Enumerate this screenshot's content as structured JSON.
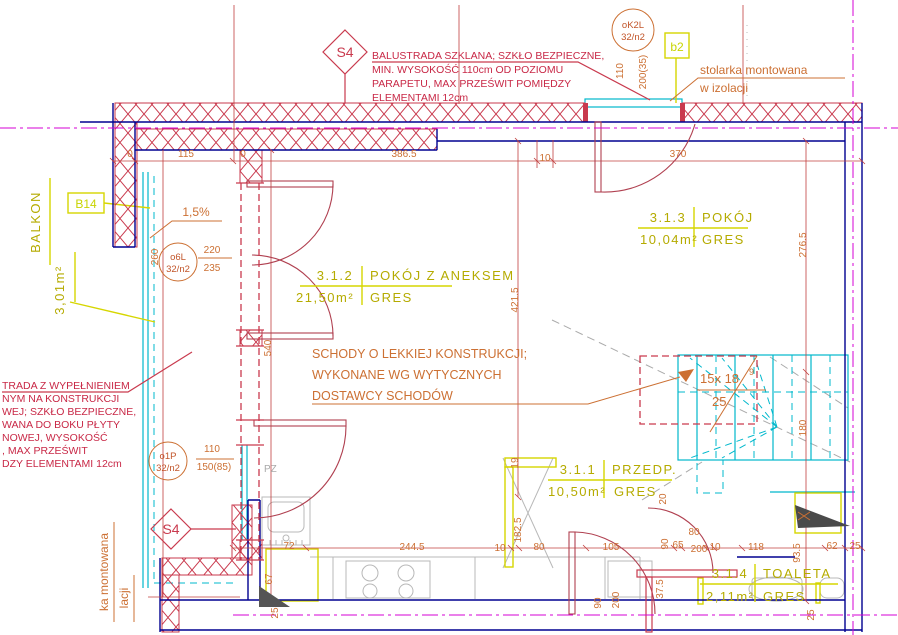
{
  "plan": {
    "symbols": {
      "s4": "S4",
      "b14": "B14",
      "b2": "b2",
      "ok2l_1": "oK2L",
      "ok2l_2": "32/n2",
      "o6l_1": "o6L",
      "o6l_2": "32/n2",
      "o1p_1": "o1P",
      "o1p_2": "32/n2"
    },
    "notes": {
      "balustrade_top": [
        "BALUSTRADA SZKLANA; SZKŁO BEZPIECZNE,",
        "MIN. WYSOKOŚĆ 110cm OD POZIOMU",
        "PARAPETU, MAX PRZEŚWIT POMIĘDZY",
        "ELEMENTAMI 12cm"
      ],
      "balustrade_left": [
        "TRADA Z WYPEŁNIENIEM",
        "NYM NA KONSTRUKCJI",
        "WEJ; SZKŁO BEZPIECZNE,",
        "WANA DO BOKU PŁYTY",
        "NOWEJ, WYSOKOŚĆ",
        ", MAX PRZEŚWIT",
        "DZY ELEMENTAMI 12cm"
      ],
      "stairs": [
        "SCHODY O LEKKIEJ KONSTRUKCJI;",
        "WYKONANE WG WYTYCZNYCH",
        "DOSTAWCY SCHODÓW"
      ],
      "stolarka_top_1": "stolarka montowana",
      "stolarka_top_2": "w izolacji",
      "stolarka_left_1": "ka montowana",
      "stolarka_left_2": "lacji",
      "slope": "1,5%",
      "pz": "PZ"
    },
    "stair_label": {
      "l1": "15x 18",
      "sup": "9",
      "l2": "25"
    },
    "balkon": {
      "name": "BALKON",
      "area": "3,01m²"
    },
    "rooms": [
      {
        "num": "3.1.2",
        "name": "POKÓJ Z ANEKSEM",
        "area": "21,50m²",
        "floor": "GRES"
      },
      {
        "num": "3.1.3",
        "name": "POKÓJ",
        "area": "10,04m²",
        "floor": "GRES"
      },
      {
        "num": "3.1.1",
        "name": "PRZEDP.",
        "area": "10,50m²",
        "floor": "GRES"
      },
      {
        "num": "3.1.4",
        "name": "TOALETA",
        "area": "2,11m²",
        "floor": "GRES"
      }
    ],
    "dims": [
      {
        "t": "0",
        "x": 130,
        "y": 157
      },
      {
        "t": "115",
        "x": 186,
        "y": 157
      },
      {
        "t": "0",
        "x": 243,
        "y": 157
      },
      {
        "t": "386.5",
        "x": 404,
        "y": 157
      },
      {
        "t": "10",
        "x": 545,
        "y": 161
      },
      {
        "t": "370",
        "x": 678,
        "y": 157
      },
      {
        "t": "110",
        "x": 623,
        "y": 71,
        "r": -90
      },
      {
        "t": "200(35)",
        "x": 646,
        "y": 72,
        "r": -90
      },
      {
        "t": "220",
        "x": 212,
        "y": 253
      },
      {
        "t": "235",
        "x": 212,
        "y": 271
      },
      {
        "t": "260",
        "x": 158,
        "y": 257,
        "r": -90
      },
      {
        "t": "540",
        "x": 271,
        "y": 348,
        "r": -90
      },
      {
        "t": "421.5",
        "x": 518,
        "y": 300,
        "r": -90
      },
      {
        "t": "276.5",
        "x": 806,
        "y": 245,
        "r": -90
      },
      {
        "t": "180",
        "x": 806,
        "y": 428,
        "r": -90
      },
      {
        "t": "110",
        "x": 212,
        "y": 452
      },
      {
        "t": "150(85)",
        "x": 214,
        "y": 470
      },
      {
        "t": "19",
        "x": 518,
        "y": 463,
        "r": -90
      },
      {
        "t": "182.5",
        "x": 521,
        "y": 530,
        "r": -90
      },
      {
        "t": "10",
        "x": 500,
        "y": 551
      },
      {
        "t": "80",
        "x": 539,
        "y": 550
      },
      {
        "t": "244.5",
        "x": 412,
        "y": 550
      },
      {
        "t": "72",
        "x": 289,
        "y": 549
      },
      {
        "t": "67",
        "x": 272,
        "y": 579,
        "r": -90
      },
      {
        "t": "25",
        "x": 278,
        "y": 613,
        "r": -90
      },
      {
        "t": "105",
        "x": 611,
        "y": 550
      },
      {
        "t": "20",
        "x": 666,
        "y": 499,
        "r": -90
      },
      {
        "t": "90",
        "x": 668,
        "y": 544,
        "r": -90
      },
      {
        "t": "65",
        "x": 678,
        "y": 548
      },
      {
        "t": "80",
        "x": 694,
        "y": 535
      },
      {
        "t": "200",
        "x": 699,
        "y": 552
      },
      {
        "t": "10",
        "x": 715,
        "y": 550
      },
      {
        "t": "118",
        "x": 756,
        "y": 550
      },
      {
        "t": "93.5",
        "x": 800,
        "y": 553,
        "r": -90
      },
      {
        "t": "62",
        "x": 832,
        "y": 549
      },
      {
        "t": "25",
        "x": 855,
        "y": 549
      },
      {
        "t": "37.5",
        "x": 663,
        "y": 589,
        "r": -90
      },
      {
        "t": "90",
        "x": 601,
        "y": 603,
        "r": -90
      },
      {
        "t": "200",
        "x": 619,
        "y": 600,
        "r": -90
      },
      {
        "t": "25",
        "x": 814,
        "y": 615,
        "r": -90
      }
    ],
    "colors": {
      "wall_red": "#c93a4e",
      "navy": "#000090",
      "magenta": "#d400d4",
      "cyan": "#00b8cc",
      "yellow": "#d6d600",
      "label_yellow": "#b5ab00",
      "dim_orange": "#cc7033",
      "note_red": "#c82846"
    }
  }
}
